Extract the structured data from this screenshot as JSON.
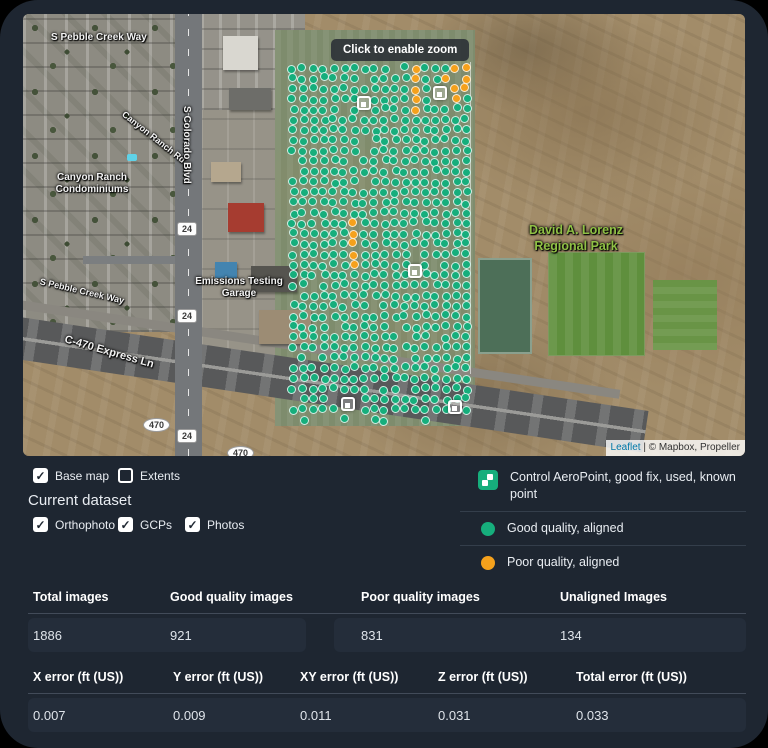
{
  "map": {
    "tooltip": "Click to enable zoom",
    "attribution": {
      "leaflet": "Leaflet",
      "rest": " | © Mapbox, Propeller"
    },
    "labels": {
      "pebble_creek_top": "S Pebble Creek Way",
      "canyon_ranch_rd": "Canyon Ranch Rd",
      "condos": "Canyon Ranch Condominiums",
      "colorado_blvd": "S Colorado Blvd",
      "emissions": "Emissions Testing Garage",
      "pebble_creek_lower": "S Pebble Creek Way",
      "express_ln": "C-470 Express Ln",
      "park_line1": "David A. Lorenz",
      "park_line2": "Regional Park",
      "shield_24": "24",
      "shield_470": "470"
    },
    "markers": {
      "grid": {
        "x0": 270,
        "y0": 54,
        "cols": 18,
        "rows": 35,
        "dx": 10.2,
        "dy": 10.35,
        "size": 9,
        "jitter": 1.6,
        "hole_rate": 0.055
      },
      "colors": {
        "good": "#16ae7c",
        "poor": "#f5a11c"
      },
      "poor_cells": [
        [
          12,
          0
        ],
        [
          12,
          1
        ],
        [
          12,
          2
        ],
        [
          12,
          3
        ],
        [
          12,
          4
        ],
        [
          16,
          0
        ],
        [
          17,
          0
        ],
        [
          15,
          1
        ],
        [
          16,
          1
        ],
        [
          17,
          1
        ],
        [
          16,
          2
        ],
        [
          17,
          2
        ],
        [
          16,
          3
        ],
        [
          6,
          15
        ],
        [
          6,
          16
        ],
        [
          6,
          17
        ],
        [
          6,
          18
        ],
        [
          6,
          19
        ],
        [
          6,
          32
        ],
        [
          6,
          33
        ]
      ],
      "gcps": [
        [
          341,
          89
        ],
        [
          417,
          79
        ],
        [
          392,
          257
        ],
        [
          325,
          390
        ],
        [
          432,
          393
        ]
      ]
    }
  },
  "controls": {
    "base_map": {
      "label": "Base map",
      "checked": true
    },
    "extents": {
      "label": "Extents",
      "checked": false
    },
    "current_dataset_title": "Current dataset",
    "orthophoto": {
      "label": "Orthophoto",
      "checked": true
    },
    "gcps": {
      "label": "GCPs",
      "checked": true
    },
    "photos": {
      "label": "Photos",
      "checked": true
    }
  },
  "legend": {
    "items": [
      {
        "label": "Control AeroPoint, good fix, used, known point",
        "color": "#16ae7c"
      },
      {
        "label": "Good quality, aligned",
        "color": "#16ae7c"
      },
      {
        "label": "Poor quality, aligned",
        "color": "#f5a11c"
      }
    ]
  },
  "image_stats": {
    "columns": [
      {
        "label": "Total images",
        "value": "1886"
      },
      {
        "label": "Good quality images",
        "value": "921"
      },
      {
        "label": "Poor quality images",
        "value": "831"
      },
      {
        "label": "Unaligned Images",
        "value": "134"
      }
    ]
  },
  "error_stats": {
    "columns": [
      {
        "label": "X error (ft (US))",
        "value": "0.007"
      },
      {
        "label": "Y error (ft (US))",
        "value": "0.009"
      },
      {
        "label": "XY error (ft (US))",
        "value": "0.011"
      },
      {
        "label": "Z error (ft (US))",
        "value": "0.031"
      },
      {
        "label": "Total error (ft (US))",
        "value": "0.033"
      }
    ]
  },
  "icons": {
    "check": "✓"
  }
}
